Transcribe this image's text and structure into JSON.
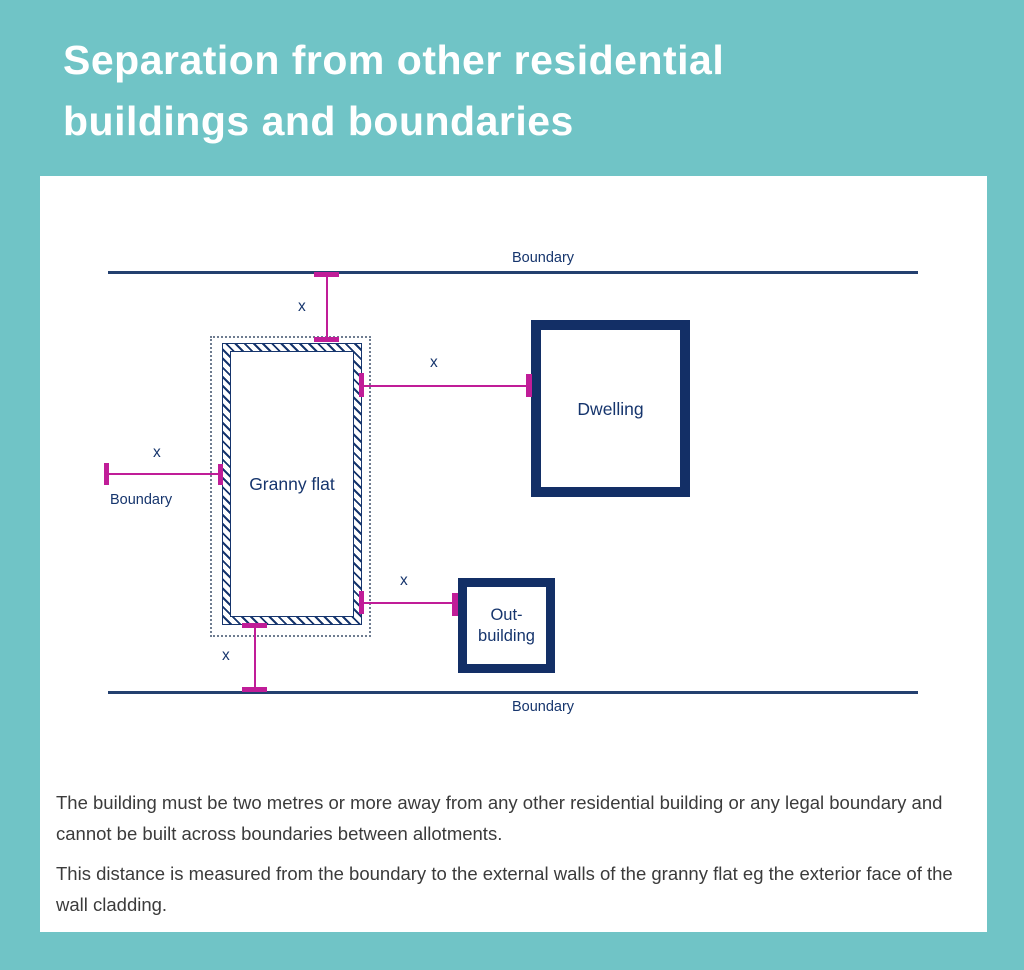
{
  "title": {
    "line1": "Separation from other residential",
    "line2": "buildings and boundaries"
  },
  "diagram": {
    "boundary_top": "Boundary",
    "boundary_bottom": "Boundary",
    "boundary_left": "Boundary",
    "granny_flat": "Granny flat",
    "dwelling": "Dwelling",
    "outbuilding_line1": "Out-",
    "outbuilding_line2": "building",
    "dim_label": "x",
    "colors": {
      "teal": "#70c4c6",
      "navy": "#16356d",
      "magenta": "#c01d98"
    }
  },
  "body": {
    "paragraph1": "The building must be two metres or more away from any other residential building or any legal boundary and cannot be built across boundaries between allotments.",
    "paragraph2": "This distance is measured from the boundary to the external walls of the granny flat eg the exterior face of the wall cladding."
  }
}
